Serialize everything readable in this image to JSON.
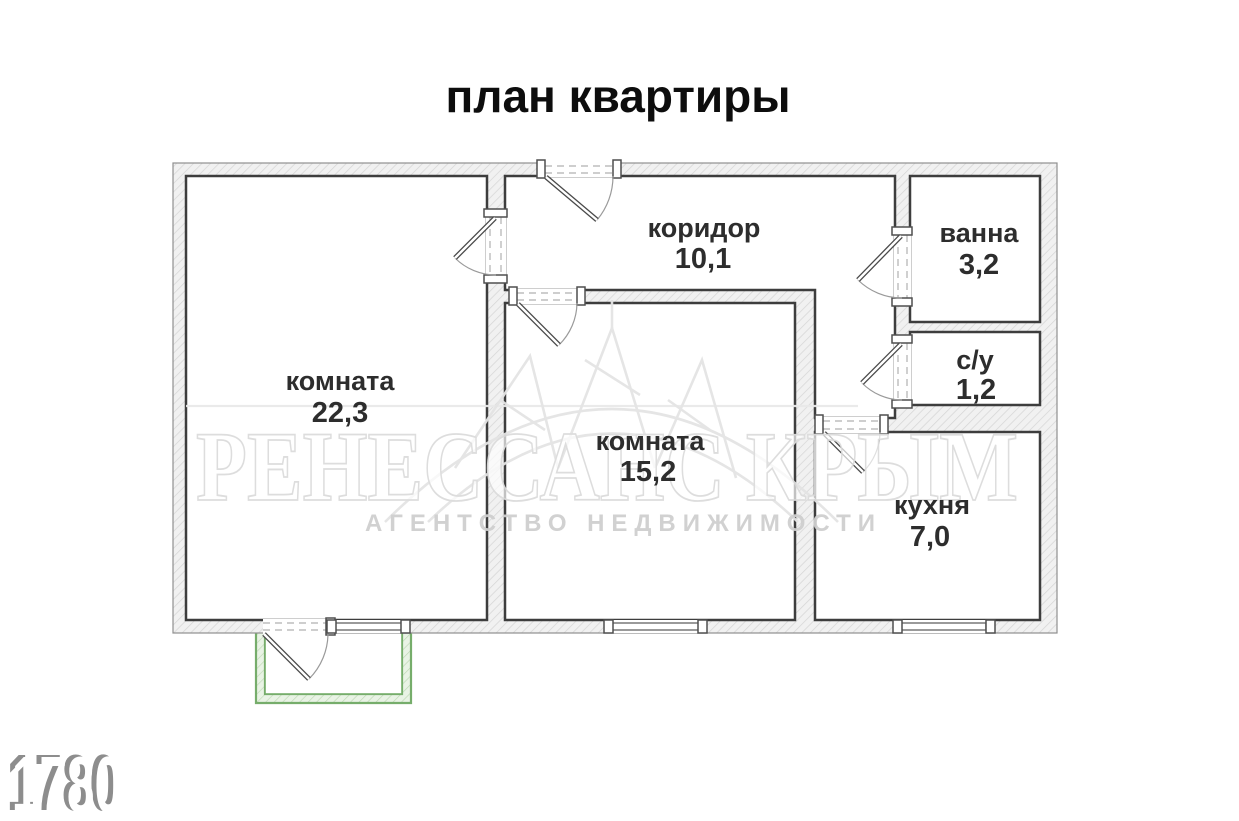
{
  "title": "план квартиры",
  "plan": {
    "rooms": [
      {
        "name": "комната",
        "area": "22,3"
      },
      {
        "name": "коридор",
        "area": "10,1"
      },
      {
        "name": "ванна",
        "area": "3,2"
      },
      {
        "name": "с/у",
        "area": "1,2"
      },
      {
        "name": "комната",
        "area": "15,2"
      },
      {
        "name": "кухня",
        "area": "7,0"
      }
    ],
    "colors": {
      "wall_outline": "#3d3d3d",
      "wall_fill": "#f1f1f1",
      "balcony_green": "#76ad6b",
      "label_text": "#2d2d2d"
    }
  },
  "watermark": {
    "brand": "РЕНЕССАНС КРЫМ",
    "tagline": "АГЕНТСТВО НЕДВИЖИМОСТИ"
  },
  "stamp": {
    "number": "1780"
  }
}
